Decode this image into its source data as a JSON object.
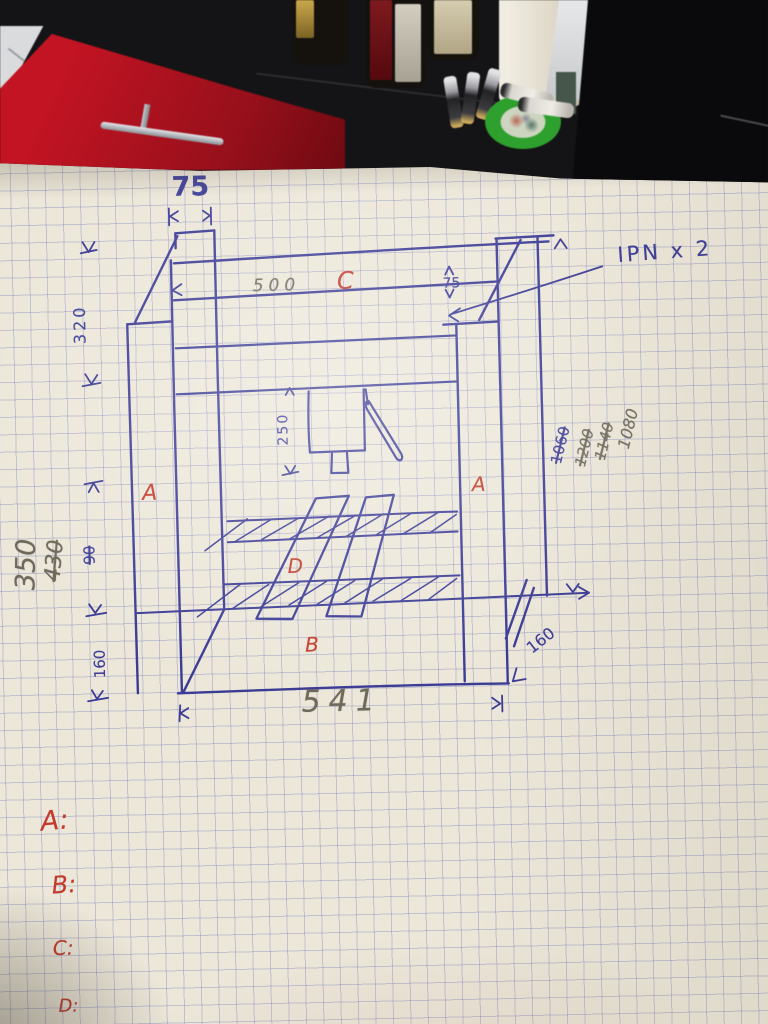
{
  "colors": {
    "ink_blue": "#3e3e98",
    "pencil_gray": "#6f695b",
    "marker_red": "#c23a2c",
    "paper": "#ece7d9",
    "cabinet_red": "#c31423"
  },
  "sketch": {
    "part_labels": {
      "left_upright": "A",
      "right_upright": "A",
      "base": "B",
      "top_beam": "C",
      "slanted_bars": "D"
    },
    "annotation_ipn": "IPN x 2",
    "dimensions": {
      "top_column_width": "75",
      "beam_span": "500",
      "beam_height": "75",
      "left_top_height": "320",
      "left_mid_height": "350",
      "left_mid_height_struck": "430",
      "left_small_struck": "90",
      "left_bottom_height": "160",
      "base_width": "541",
      "bottom_right_offset": "160",
      "press_stroke": "250",
      "right_heights": [
        {
          "value": "1060",
          "struck": true
        },
        {
          "value": "1200",
          "struck": true
        },
        {
          "value": "1140",
          "struck": true
        },
        {
          "value": "1080",
          "struck": false
        }
      ]
    },
    "legend": [
      {
        "label": "A:"
      },
      {
        "label": "B:"
      },
      {
        "label": "C:"
      },
      {
        "label": "D:"
      }
    ]
  }
}
